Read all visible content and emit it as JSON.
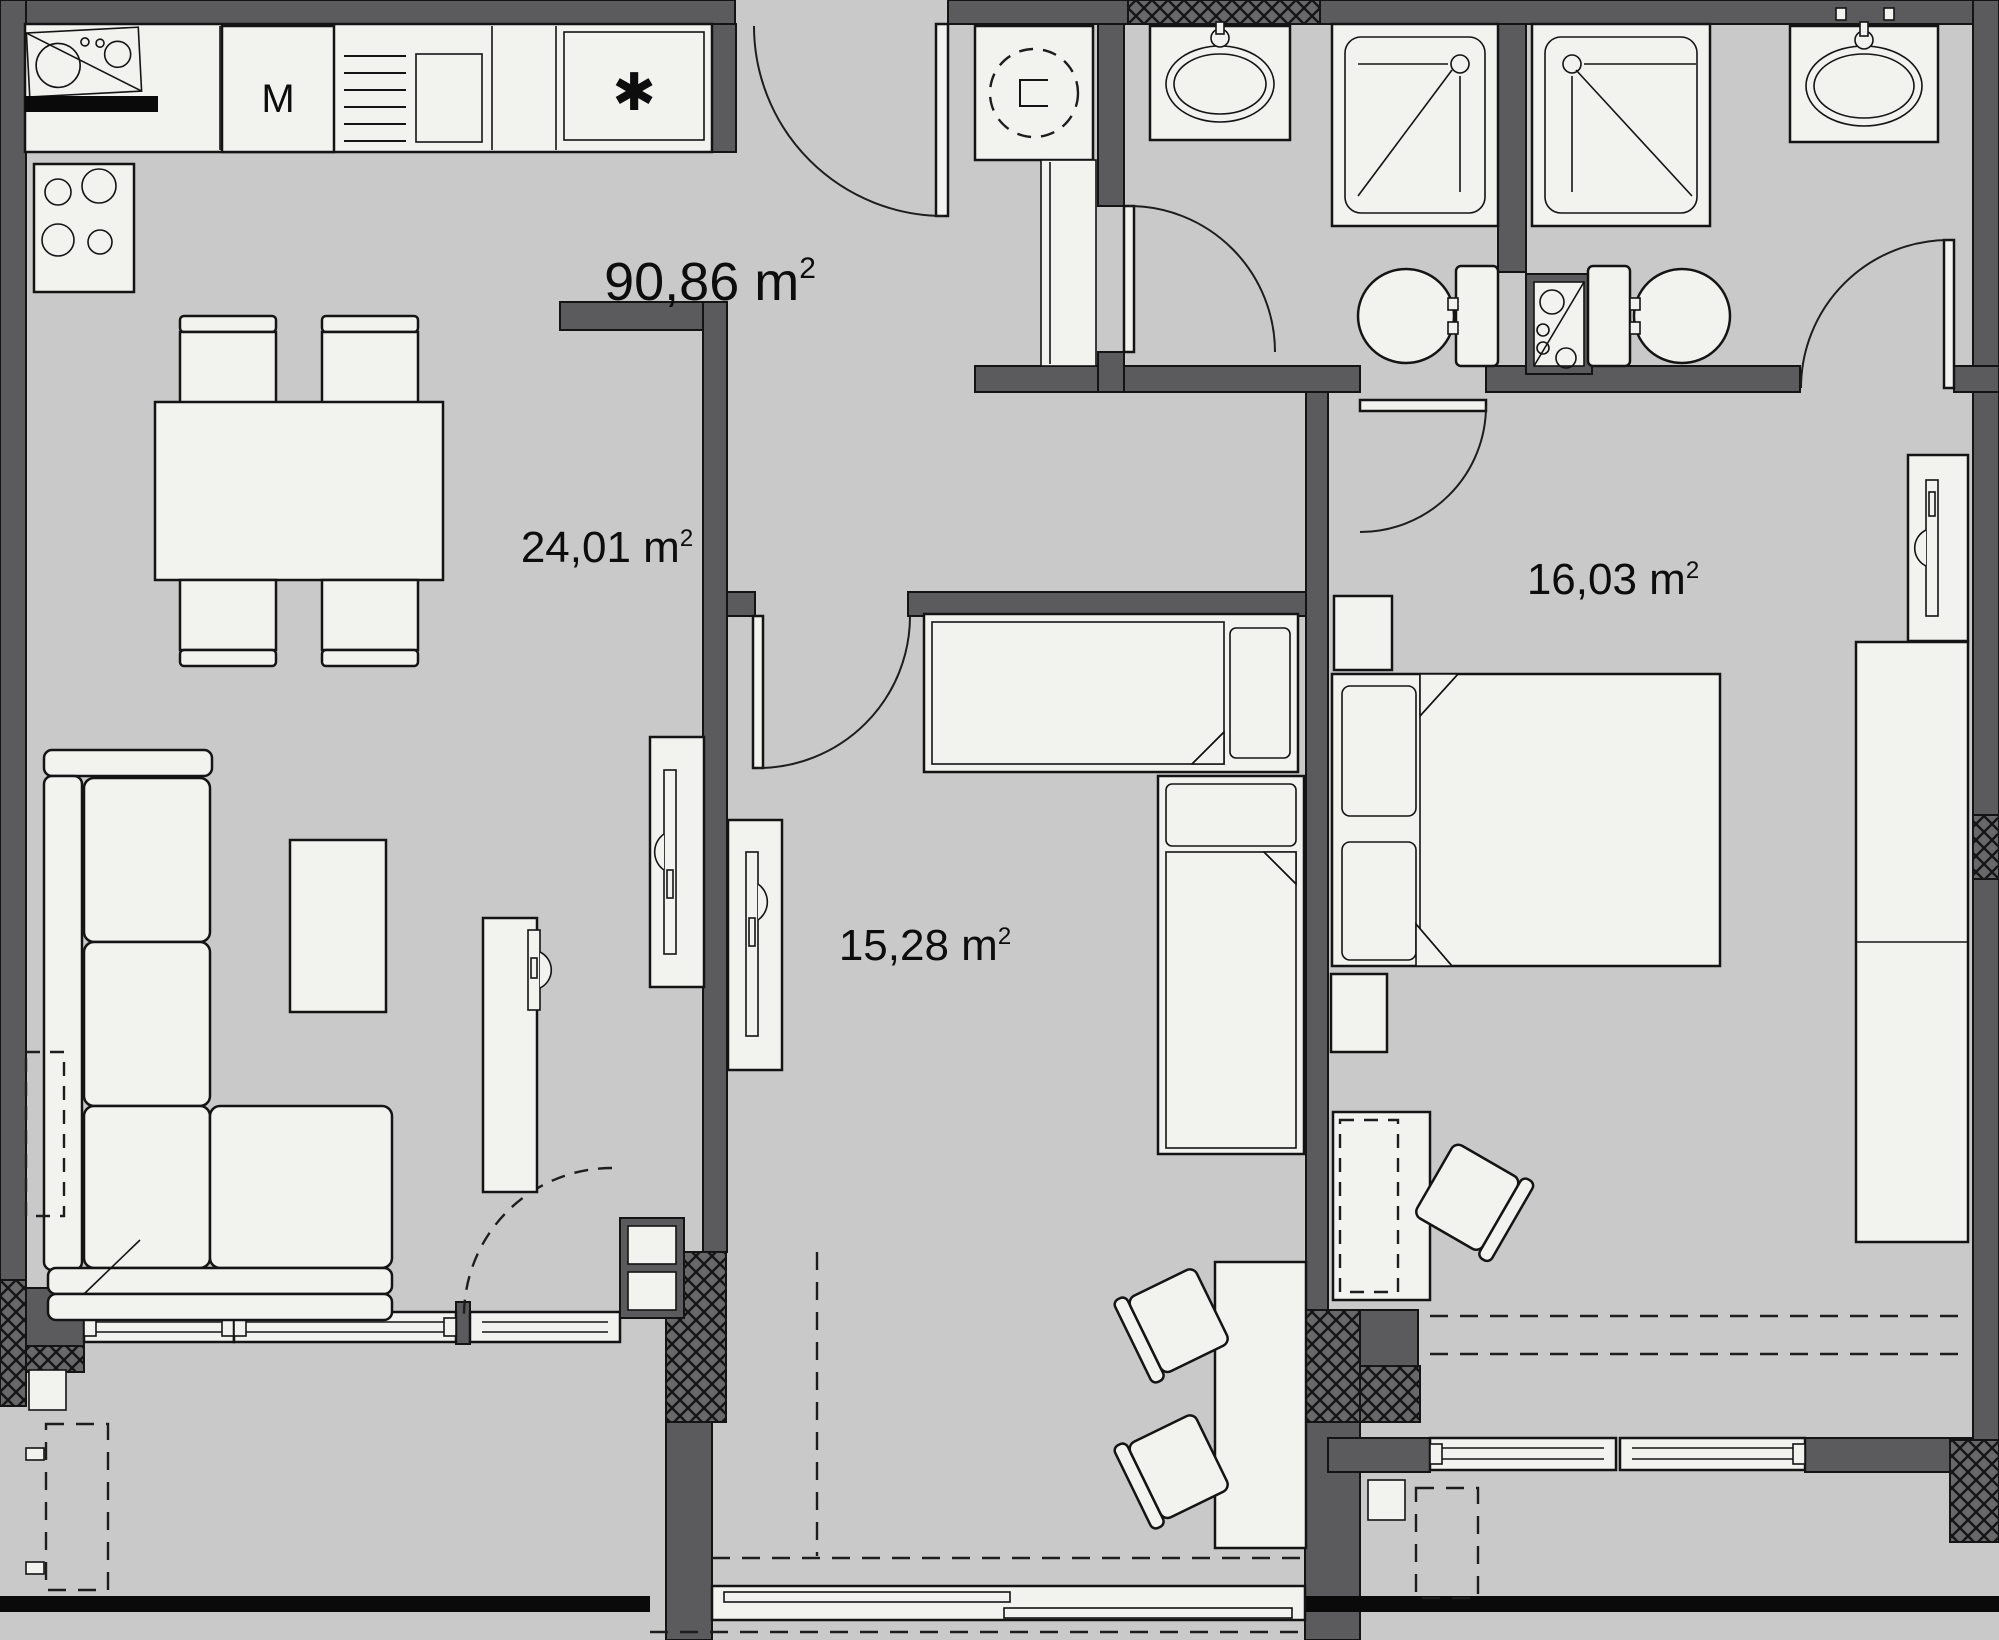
{
  "plan": {
    "type": "apartment-floor-plan",
    "area_labels": {
      "total": {
        "text": "90,86 m",
        "sup": "2",
        "value_m2": 90.86
      },
      "living_kitchen": {
        "text": "24,01 m",
        "sup": "2",
        "value_m2": 24.01
      },
      "child_room": {
        "text": "15,28 m",
        "sup": "2",
        "value_m2": 15.28
      },
      "bedroom": {
        "text": "16,03 m",
        "sup": "2",
        "value_m2": 16.03
      }
    },
    "appliance_labels": {
      "washing_machine": "M",
      "freezer_star": "✱"
    },
    "colors": {
      "floor": "#c9c9c9",
      "wall": "#5b5b5e",
      "fixture": "#f2f2ee",
      "line": "#141414",
      "hatch": "#68686b",
      "slab_edge": "#0a0a0a"
    }
  }
}
